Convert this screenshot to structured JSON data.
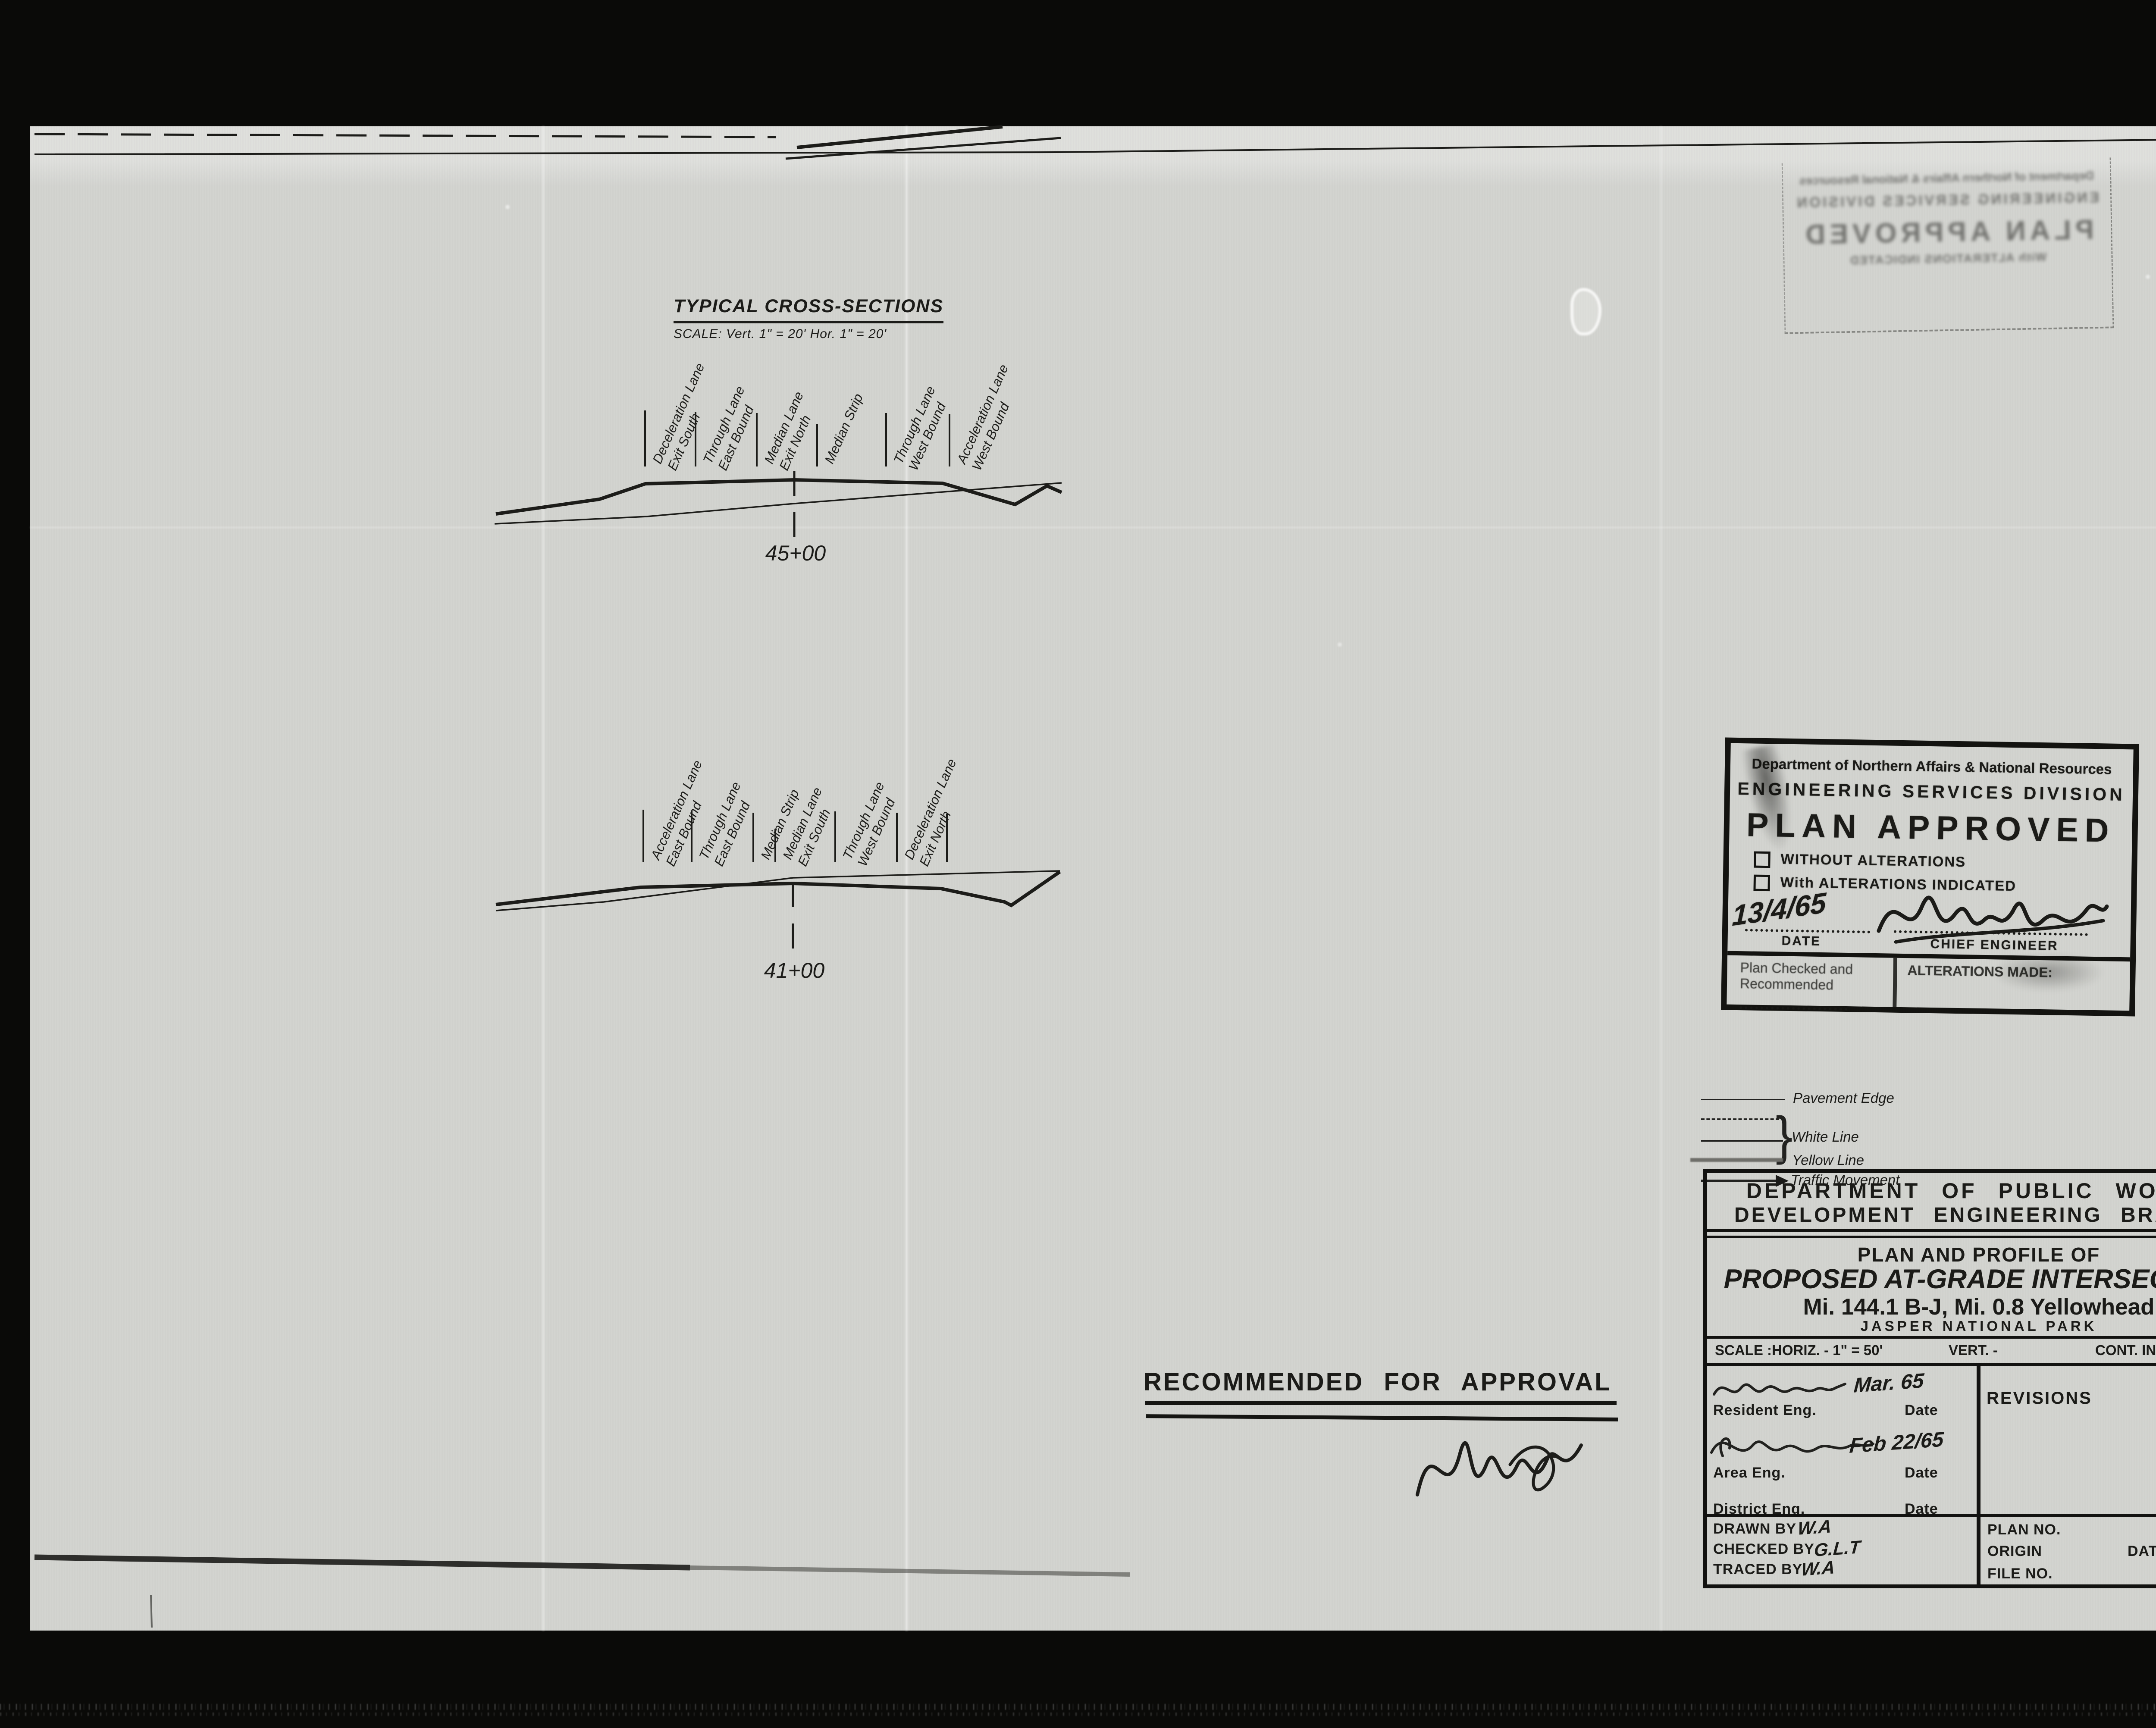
{
  "sheet": {
    "cross_sections": {
      "title": "TYPICAL CROSS-SECTIONS",
      "scale_note": "SCALE: Vert. 1\" = 20'   Hor. 1\" = 20'",
      "station_a": "45+00",
      "station_b": "41+00",
      "lanes_a": [
        {
          "l1": "Deceleration Lane",
          "l2": "Exit South"
        },
        {
          "l1": "Through Lane",
          "l2": "East Bound"
        },
        {
          "l1": "Median Lane",
          "l2": "Exit North"
        },
        {
          "l1": "Median Strip",
          "l2": ""
        },
        {
          "l1": "Through Lane",
          "l2": "West Bound"
        },
        {
          "l1": "Acceleration Lane",
          "l2": "West Bound"
        }
      ],
      "lanes_b": [
        {
          "l1": "Acceleration Lane",
          "l2": "East Bound"
        },
        {
          "l1": "Through Lane",
          "l2": "East Bound"
        },
        {
          "l1": "Median Strip",
          "l2": ""
        },
        {
          "l1": "Median Lane",
          "l2": "Exit South"
        },
        {
          "l1": "Through Lane",
          "l2": "West Bound"
        },
        {
          "l1": "Deceleration Lane",
          "l2": "Exit North"
        }
      ]
    },
    "approval_stamp": {
      "agency": "Department of Northern Affairs & National Resources",
      "division": "ENGINEERING SERVICES DIVISION",
      "title": "PLAN APPROVED",
      "opt_without": "WITHOUT ALTERATIONS",
      "opt_with": "With ALTERATIONS INDICATED",
      "date_value": "13/4/65",
      "date_label": "DATE",
      "chief_label": "CHIEF ENGINEER",
      "checked1": "Plan Checked and",
      "checked2": "Recommended",
      "alterations": "ALTERATIONS MADE:"
    },
    "legend": {
      "pavement_edge": "Pavement Edge",
      "white_line": "White Line",
      "yellow_line": "Yellow Line",
      "traffic_movement": "Traffic Movement"
    },
    "title_block": {
      "dept1": "DEPARTMENT OF PUBLIC WORKS",
      "dept2": "DEVELOPMENT ENGINEERING BRANCH",
      "title1": "PLAN AND PROFILE OF",
      "title2": "PROPOSED AT-GRADE INTERSECTION",
      "title3": "Mi. 144.1 B-J, Mi. 0.8 Yellowhead",
      "title4": "JASPER NATIONAL PARK",
      "scale_label": "SCALE :",
      "horiz": "HORIZ. - 1\" = 50'",
      "vert": "VERT. -",
      "cont": "CONT. INT. -",
      "resident": "Resident Eng.",
      "resident_date": "Mar. 65",
      "area": "Area Eng.",
      "area_date": "Feb 22/65",
      "district": "District Eng.",
      "date": "Date",
      "revisions": "REVISIONS",
      "drawn_label": "DRAWN BY",
      "drawn": "W.A",
      "checked_label": "CHECKED BY",
      "checked": "G.L.T",
      "traced_label": "TRACED BY",
      "traced": "W.A",
      "plan_no": "PLAN NO.",
      "origin": "ORIGIN",
      "date2": "DATE",
      "file_no": "FILE NO."
    },
    "recommendation": {
      "text": "RECOMMENDED FOR APPROVAL"
    },
    "page_label": {
      "printed": "6 OF/DE",
      "handwritten": "6"
    }
  }
}
